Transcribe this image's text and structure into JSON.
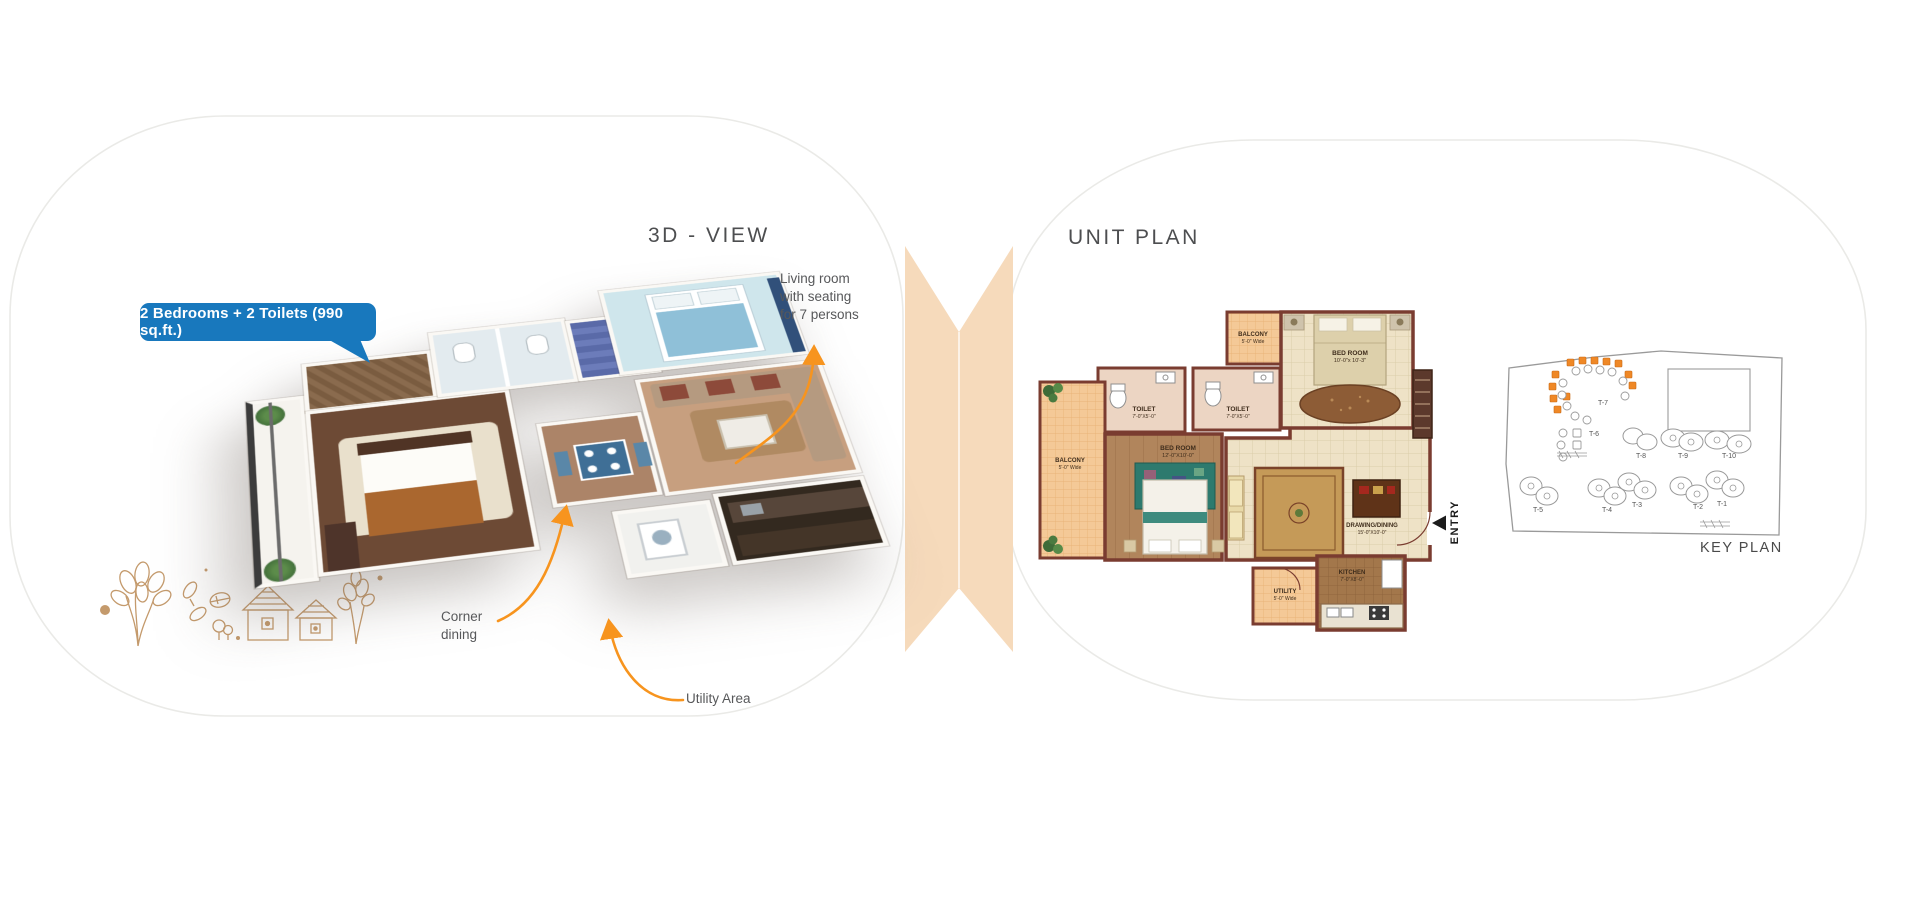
{
  "badge": {
    "label": "2 Bedrooms + 2 Toilets (990 sq.ft.)"
  },
  "left_page": {
    "title": "3D - VIEW",
    "annotations": {
      "living_room": "Living room\nwith seating\nfor 7 persons",
      "corner_dining": "Corner\ndining",
      "utility_area": "Utility Area"
    }
  },
  "right_page": {
    "title": "UNIT PLAN",
    "unit_plan": {
      "rooms": {
        "balcony_top": {
          "name": "BALCONY",
          "size": "5'-0\" Wide"
        },
        "bed_room_top": {
          "name": "BED ROOM",
          "size": "10'-0\"x 10'-3\""
        },
        "toilet_left": {
          "name": "TOILET",
          "size": "7'-0\"X5'-0\""
        },
        "toilet_right": {
          "name": "TOILET",
          "size": "7'-0\"X5'-0\""
        },
        "balcony_left": {
          "name": "BALCONY",
          "size": "5'-0\" Wide"
        },
        "bed_room_mid": {
          "name": "BED ROOM",
          "size": "12'-0\"X10'-0\""
        },
        "drawing_dining": {
          "name": "DRAWING/DINING",
          "size": "15'-0\"X10'-0\""
        },
        "utility": {
          "name": "UTILITY",
          "size": "5'-0\" Wide"
        },
        "kitchen": {
          "name": "KITCHEN",
          "size": "7'-0\"X8'-0\""
        }
      },
      "entry_label": "ENTRY"
    },
    "key_plan": {
      "label": "KEY PLAN",
      "towers": [
        "T-1",
        "T-2",
        "T-3",
        "T-4",
        "T-5",
        "T-6",
        "T-7",
        "T-8",
        "T-9",
        "T-10"
      ]
    }
  },
  "colors": {
    "badge_blue": "#1878bd",
    "arrow_orange": "#f7941e",
    "highlight_orange": "#ef8826",
    "fold_peach": "#f6dabb",
    "wall_brown": "#7a3c30",
    "motif_tan": "#c49a6c"
  }
}
